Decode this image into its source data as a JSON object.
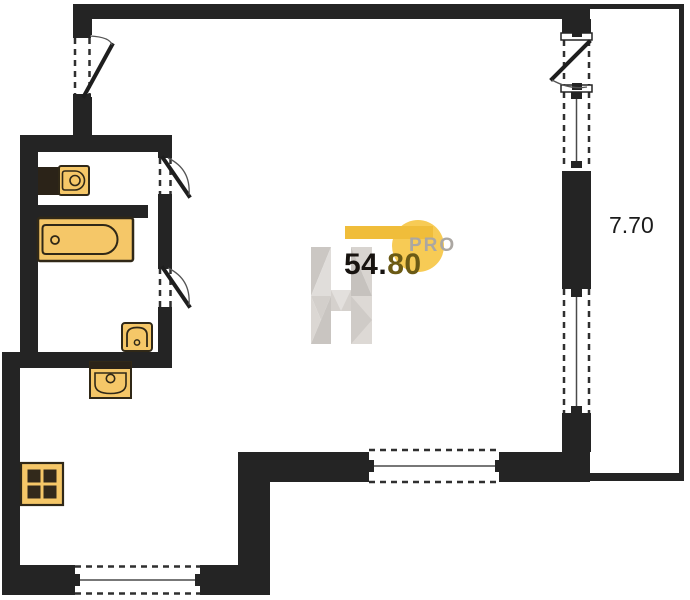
{
  "floor_plan": {
    "type": "apartment-floor-plan",
    "area_value": {
      "main": "54.",
      "decimal": "80",
      "full": "54.80"
    },
    "balcony_length": "7.70",
    "watermark": {
      "brand_letter": "H",
      "brand_suffix": "PRO"
    },
    "colors": {
      "wall": "#242424",
      "background": "#ffffff",
      "fixture_fill": "#f5c768",
      "fixture_outline": "#302817",
      "watermark_bar": "#f0bd3a",
      "watermark_circle": "#f7cb55",
      "watermark_letter_gray": "#d5d1cd",
      "area_main_color": "#171310",
      "area_decimal_color": "#6b5a15",
      "dimension_color": "#1b1b1b"
    },
    "fixtures": [
      {
        "name": "wash-basin"
      },
      {
        "name": "bathtub"
      },
      {
        "name": "toilet"
      },
      {
        "name": "kitchen-sink"
      },
      {
        "name": "stove"
      }
    ],
    "openings": [
      {
        "name": "entry-door-left"
      },
      {
        "name": "bathroom-door-upper"
      },
      {
        "name": "bathroom-door-lower"
      },
      {
        "name": "casement-window-top-right"
      },
      {
        "name": "window-right-upper"
      },
      {
        "name": "window-right-lower"
      },
      {
        "name": "window-bottom-main"
      },
      {
        "name": "window-bottom-kitchen"
      }
    ]
  }
}
